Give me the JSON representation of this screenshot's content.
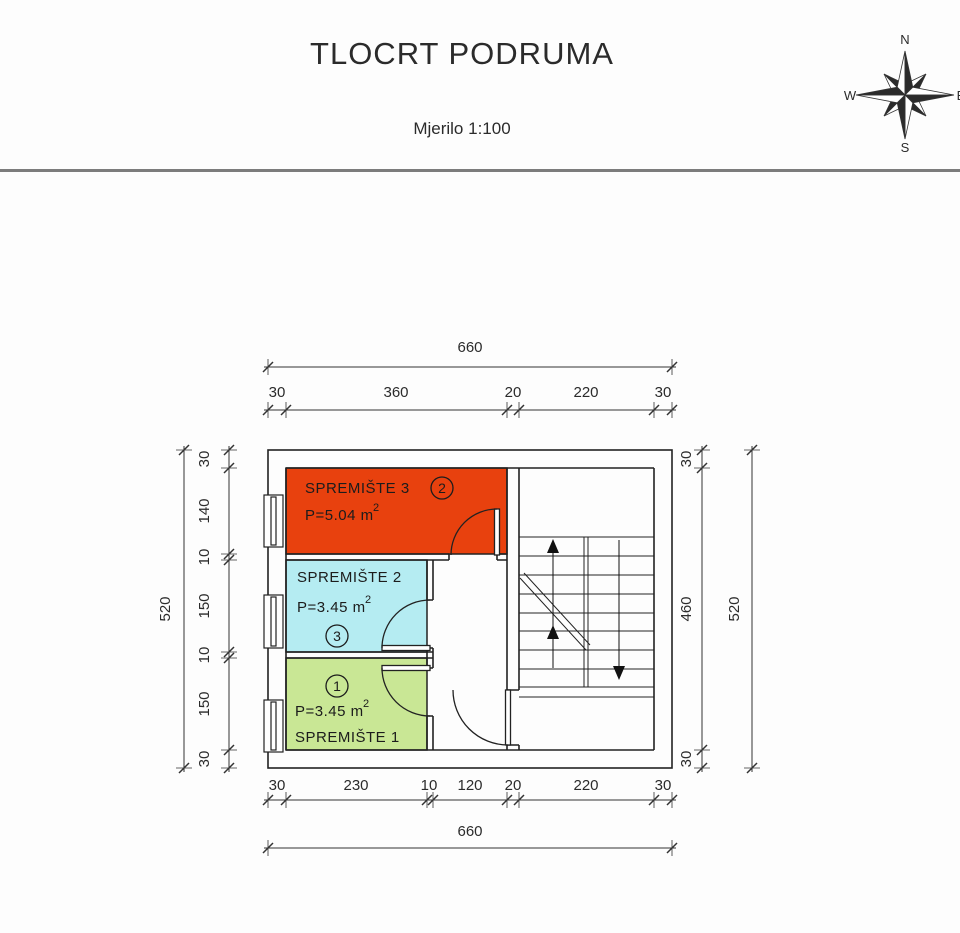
{
  "header": {
    "title": "TLOCRT PODRUMA",
    "scale_label": "Mjerilo 1:100"
  },
  "compass": {
    "north": "N",
    "east": "E",
    "south": "S",
    "west": "W"
  },
  "rooms": [
    {
      "name": "SPREMIŠTE 3",
      "circle_number": "2",
      "area_value": "P=5.04 m",
      "area_superscript": "2",
      "fill": "#e8410e"
    },
    {
      "name": "SPREMIŠTE 2",
      "circle_number": "3",
      "area_value": "P=3.45 m",
      "area_superscript": "2",
      "fill": "#b5ecf2"
    },
    {
      "name": "SPREMIŠTE 1",
      "circle_number": "1",
      "area_value": "P=3.45 m",
      "area_superscript": "2",
      "fill": "#c9e795"
    }
  ],
  "dimensions": {
    "top": {
      "total": "660",
      "segments": [
        "30",
        "360",
        "20",
        "220",
        "30"
      ]
    },
    "bottom": {
      "total": "660",
      "segments": [
        "30",
        "230",
        "10",
        "120",
        "20",
        "220",
        "30"
      ]
    },
    "left": {
      "total": "520",
      "segments": [
        "30",
        "140",
        "10",
        "150",
        "10",
        "150",
        "30"
      ]
    },
    "right": {
      "total": "520",
      "segments": [
        "30",
        "460",
        "30"
      ]
    }
  }
}
